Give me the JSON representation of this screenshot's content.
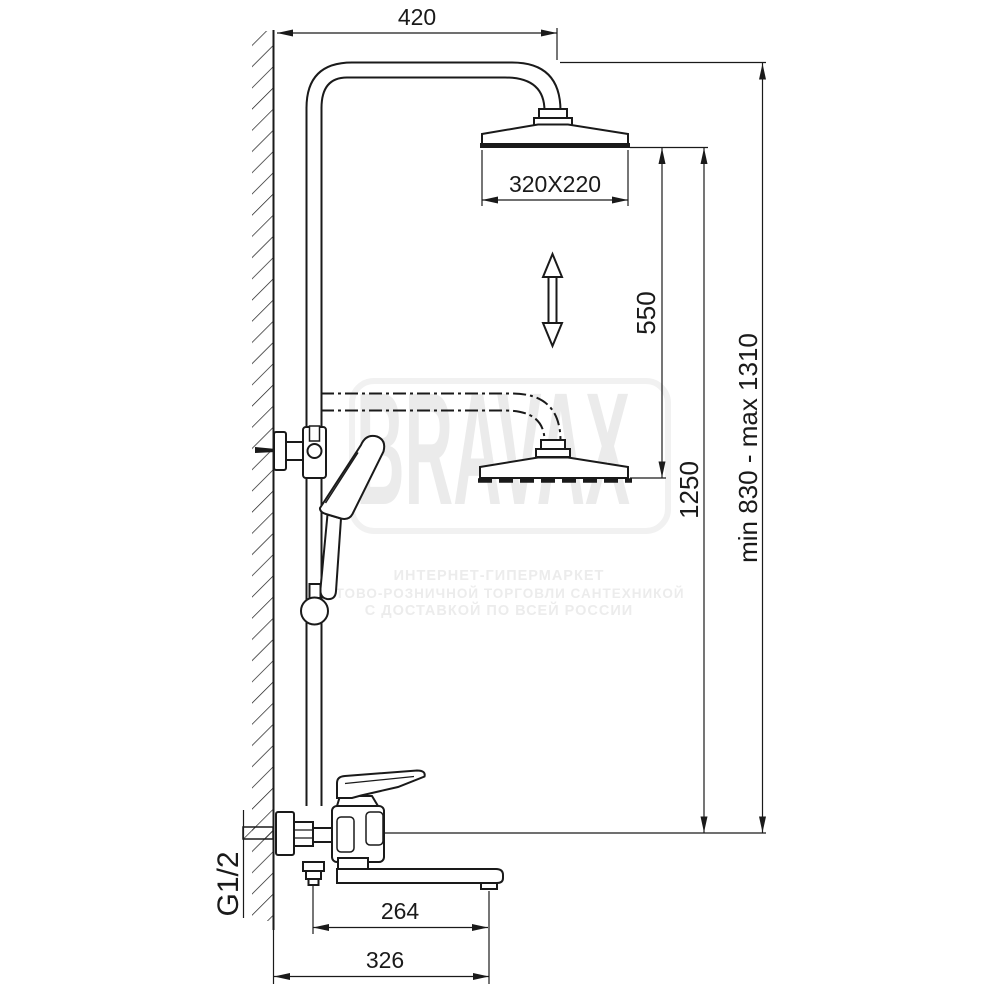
{
  "drawing": {
    "title": "shower-column-technical-drawing",
    "dimensions": {
      "top_offset": "420",
      "head_size": "320X220",
      "height_adjust": "550",
      "head_height": "1250",
      "total_height": "min 830 - max 1310",
      "spout_reach": "264",
      "wall_to_spout": "326",
      "connection": "G1/2"
    },
    "watermark": {
      "brand": "BRAVAX",
      "line1": "ИНТЕРНЕТ-ГИПЕРМАРКЕТ",
      "line2": "ОПТОВО-РОЗНИЧНОЙ ТОРГОВЛИ САНТЕХНИКОЙ",
      "line3": "С ДОСТАВКОЙ ПО ВСЕЙ РОССИИ"
    },
    "colors": {
      "line": "#1a1a1a",
      "watermark_text": "#ebebeb",
      "watermark_frame": "#f1f1f1",
      "background": "#ffffff"
    }
  }
}
